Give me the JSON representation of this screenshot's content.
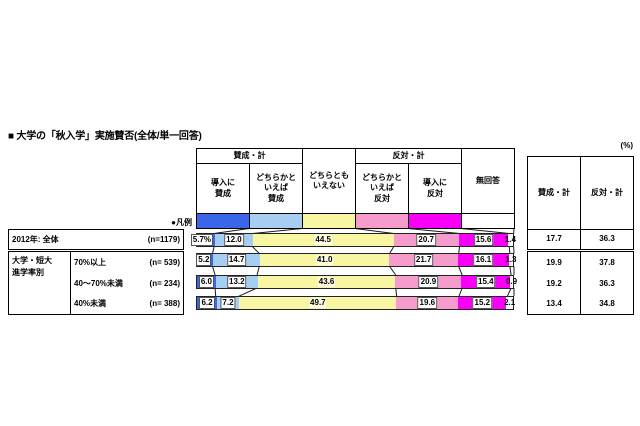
{
  "title": "■ 大学の「秋入学」実施賛否(全体/単一回答)",
  "percent_unit_note": "(%)",
  "legend_label": "●凡例",
  "header": {
    "agree_total": "賛成・計",
    "oppose_total": "反対・計",
    "columns": [
      "導入に\n賛成",
      "どちらかと\nいえば\n賛成",
      "どちらとも\nいえない",
      "どちらかと\nいえば\n反対",
      "導入に\n反対",
      "無回答"
    ]
  },
  "summary": {
    "columns": [
      "賛成・計",
      "反対・計"
    ]
  },
  "chart_data": {
    "type": "bar",
    "stacked": true,
    "orientation": "horizontal",
    "unit": "%",
    "series_labels": [
      "導入に賛成",
      "どちらかといえば賛成",
      "どちらともいえない",
      "どちらかといえば反対",
      "導入に反対",
      "無回答"
    ],
    "colors": [
      "#3a67e8",
      "#a6cdf2",
      "#f8f5a3",
      "#f59ccd",
      "#f800f8",
      "#ffffff"
    ],
    "group_label": "大学・短大\n進学率別",
    "rows": [
      {
        "label": "2012年: 全体",
        "n_label": "(n=1179)",
        "values": [
          5.7,
          12.0,
          44.5,
          20.7,
          15.6,
          1.4
        ],
        "value_labels": [
          "5.7%",
          "12.0",
          "44.5",
          "20.7",
          "15.6",
          "1.4"
        ],
        "agree_total": "17.7",
        "oppose_total": "36.3",
        "in_group": false
      },
      {
        "label": "70%以上",
        "n_label": "(n= 539)",
        "values": [
          5.2,
          14.7,
          41.0,
          21.7,
          16.1,
          1.3
        ],
        "value_labels": [
          "5.2",
          "14.7",
          "41.0",
          "21.7",
          "16.1",
          "1.3"
        ],
        "agree_total": "19.9",
        "oppose_total": "37.8",
        "in_group": true
      },
      {
        "label": "40～70%未満",
        "n_label": "(n= 234)",
        "values": [
          6.0,
          13.2,
          43.6,
          20.9,
          15.4,
          0.9
        ],
        "value_labels": [
          "6.0",
          "13.2",
          "43.6",
          "20.9",
          "15.4",
          "0.9"
        ],
        "agree_total": "19.2",
        "oppose_total": "36.3",
        "in_group": true
      },
      {
        "label": "40%未満",
        "n_label": "(n= 388)",
        "values": [
          6.2,
          7.2,
          49.7,
          19.6,
          15.2,
          2.1
        ],
        "value_labels": [
          "6.2",
          "7.2",
          "49.7",
          "19.6",
          "15.2",
          "2.1"
        ],
        "agree_total": "13.4",
        "oppose_total": "34.8",
        "in_group": true
      }
    ]
  }
}
